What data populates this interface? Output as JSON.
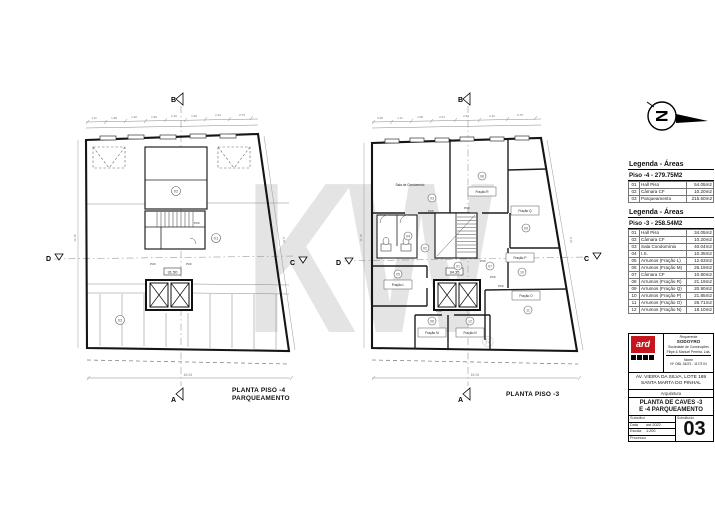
{
  "watermark": {
    "text": "KW",
    "registered_mark": "®"
  },
  "compass": {
    "letter": "N"
  },
  "plans": [
    {
      "title_line1": "PLANTA PISO -4",
      "title_line2": "PARQUEAMENTO",
      "markers": {
        "top": "B",
        "bottom": "A",
        "left": "D",
        "right": "C"
      },
      "level": "31.50",
      "unit_numbers": [
        "01",
        "02",
        "03"
      ],
      "dims_top": [
        "1.11",
        "1.98",
        "1.30",
        "1.90",
        "2.16",
        "1.60",
        "2.22",
        "0.75"
      ],
      "dim_bottom": "16.91",
      "dim_left": "11.15",
      "dim_right": "9.10"
    },
    {
      "title_line1": "PLANTA PISO -3",
      "markers": {
        "top": "B",
        "bottom": "A",
        "left": "D",
        "right": "C"
      },
      "level": "34.35",
      "rooms": {
        "sala": "Sala de Condomínio",
        "fr_r": "Fração R",
        "fr_q": "Fração Q",
        "fr_p": "Fração P",
        "fr_o": "Fração O",
        "fr_l": "Fração L",
        "fr_m": "Fração M",
        "fr_n": "Fração N"
      },
      "unit_numbers": [
        "01",
        "02",
        "03",
        "04",
        "05",
        "06",
        "07",
        "08",
        "09",
        "10",
        "11",
        "12"
      ],
      "dims_top": [
        "0.99",
        "1.11",
        "1.98",
        "2.01",
        "2.81",
        "2.22",
        "0.75"
      ],
      "dim_bottom": "16.91",
      "dim_left": "11.15",
      "dim_right": "9.10"
    }
  ],
  "labels": {
    "pcf": "PCF"
  },
  "legend_piso4": {
    "header": "Legenda - Áreas",
    "subheader": "Piso -4 - 279.75M2",
    "rows": [
      {
        "num": "01",
        "name": "Hall Piso",
        "area": "54.05m2"
      },
      {
        "num": "02",
        "name": "Câmara CF",
        "area": "10.20m2"
      },
      {
        "num": "03",
        "name": "Parqueamento",
        "area": "215.50m2"
      }
    ]
  },
  "legend_piso3": {
    "header": "Legenda - Áreas",
    "subheader": "Piso -3 - 258.54M2",
    "rows": [
      {
        "num": "01",
        "name": "Hall Piso",
        "area": "34.05m2"
      },
      {
        "num": "02",
        "name": "Câmara CF",
        "area": "10.20m2"
      },
      {
        "num": "03",
        "name": "Sala Condomínio",
        "area": "40.04m2"
      },
      {
        "num": "04",
        "name": "I.S.",
        "area": "10.35m2"
      },
      {
        "num": "05",
        "name": "Arrumos (Fração L)",
        "area": "12.63m2"
      },
      {
        "num": "06",
        "name": "Arrumos (Fração M)",
        "area": "26.19m2"
      },
      {
        "num": "07",
        "name": "Câmara CF",
        "area": "10.80m2"
      },
      {
        "num": "08",
        "name": "Arrumos (Fração R)",
        "area": "21.19m2"
      },
      {
        "num": "09",
        "name": "Arrumos (Fração Q)",
        "area": "20.90m2"
      },
      {
        "num": "10",
        "name": "Arrumos (Fração P)",
        "area": "21.85m2"
      },
      {
        "num": "11",
        "name": "Arrumos (Fração O)",
        "area": "26.71m2"
      },
      {
        "num": "12",
        "name": "Arrumos (Fração N)",
        "area": "18.10m2"
      }
    ]
  },
  "title_block": {
    "logo_text": "ard",
    "requerente_label": "Requerente",
    "requerente_name": "SODOYRO",
    "requerente_line2": "Sociedade de Construções",
    "requerente_line3": "Filipe & Manuel Pereira, Lda.",
    "obra_label": "Nome",
    "process_ref": "Nº OBL 34/23 - 117/3 IN",
    "address_line1": "AV. VIEIRA DA SILVA, LOTE 169",
    "address_line2": "SANTA MARTA DO PINHAL",
    "specialty": "Arquitetura",
    "title_line1": "PLANTA DE CAVES -3",
    "title_line2": "E -4 PARQUEAMENTO",
    "substitui_label": "Substitui",
    "data_label": "Data",
    "data_value": "out 2022",
    "escala_label": "Escala",
    "escala_value": "1:200",
    "processo_label": "Processo",
    "substituido_label": "Substituído",
    "sheet_number": "03"
  }
}
